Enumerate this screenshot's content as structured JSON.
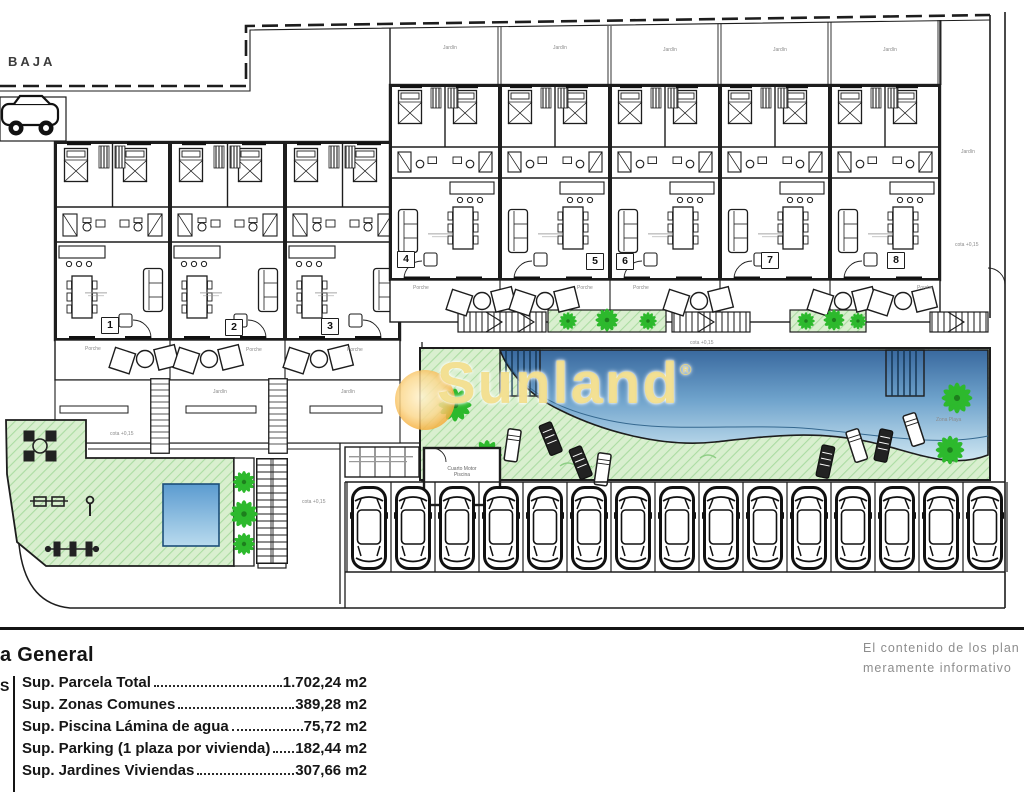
{
  "plan": {
    "floor_label": "BAJA",
    "watermark": {
      "brand": "Sunland",
      "registered": "®"
    },
    "unit_numbers": [
      "1",
      "2",
      "3",
      "4",
      "5",
      "6",
      "7",
      "8"
    ],
    "area_labels": {
      "porche": "Porche",
      "jardin": "Jardín",
      "cota": "cota +0,15",
      "zona_playa": "Zona Playa",
      "pool_room_line1": "Cuarto Motor",
      "pool_room_line2": "Piscina"
    },
    "parking": {
      "spaces": 15
    }
  },
  "legend": {
    "title_fragment": "a General",
    "left_fragment": "S",
    "rows": [
      {
        "label": "Sup. Parcela Total",
        "value": "1.702,24 m2"
      },
      {
        "label": "Sup. Zonas Comunes",
        "value": "389,28 m2"
      },
      {
        "label": "Sup. Piscina Lámina de agua",
        "value": "75,72 m2"
      },
      {
        "label": "Sup. Parking (1 plaza por vivienda)",
        "value": "182,44 m2"
      },
      {
        "label": "Sup. Jardines Viviendas",
        "value": "307,66 m2"
      }
    ],
    "disclaimer": [
      "El contenido de los plan",
      "meramente informativo"
    ]
  },
  "colors": {
    "line": "#1d1d1d",
    "lawn": "#d9efcf",
    "lawn_hatch": "#abdca2",
    "palm_green": "#2db92d",
    "pool_deep": "#39699f",
    "pool_shallow": "#cfe7f2",
    "watermark_orange": "#f5a933",
    "watermark_yellow": "#f0d878",
    "disclaimer_gray": "#8d8d8d"
  }
}
